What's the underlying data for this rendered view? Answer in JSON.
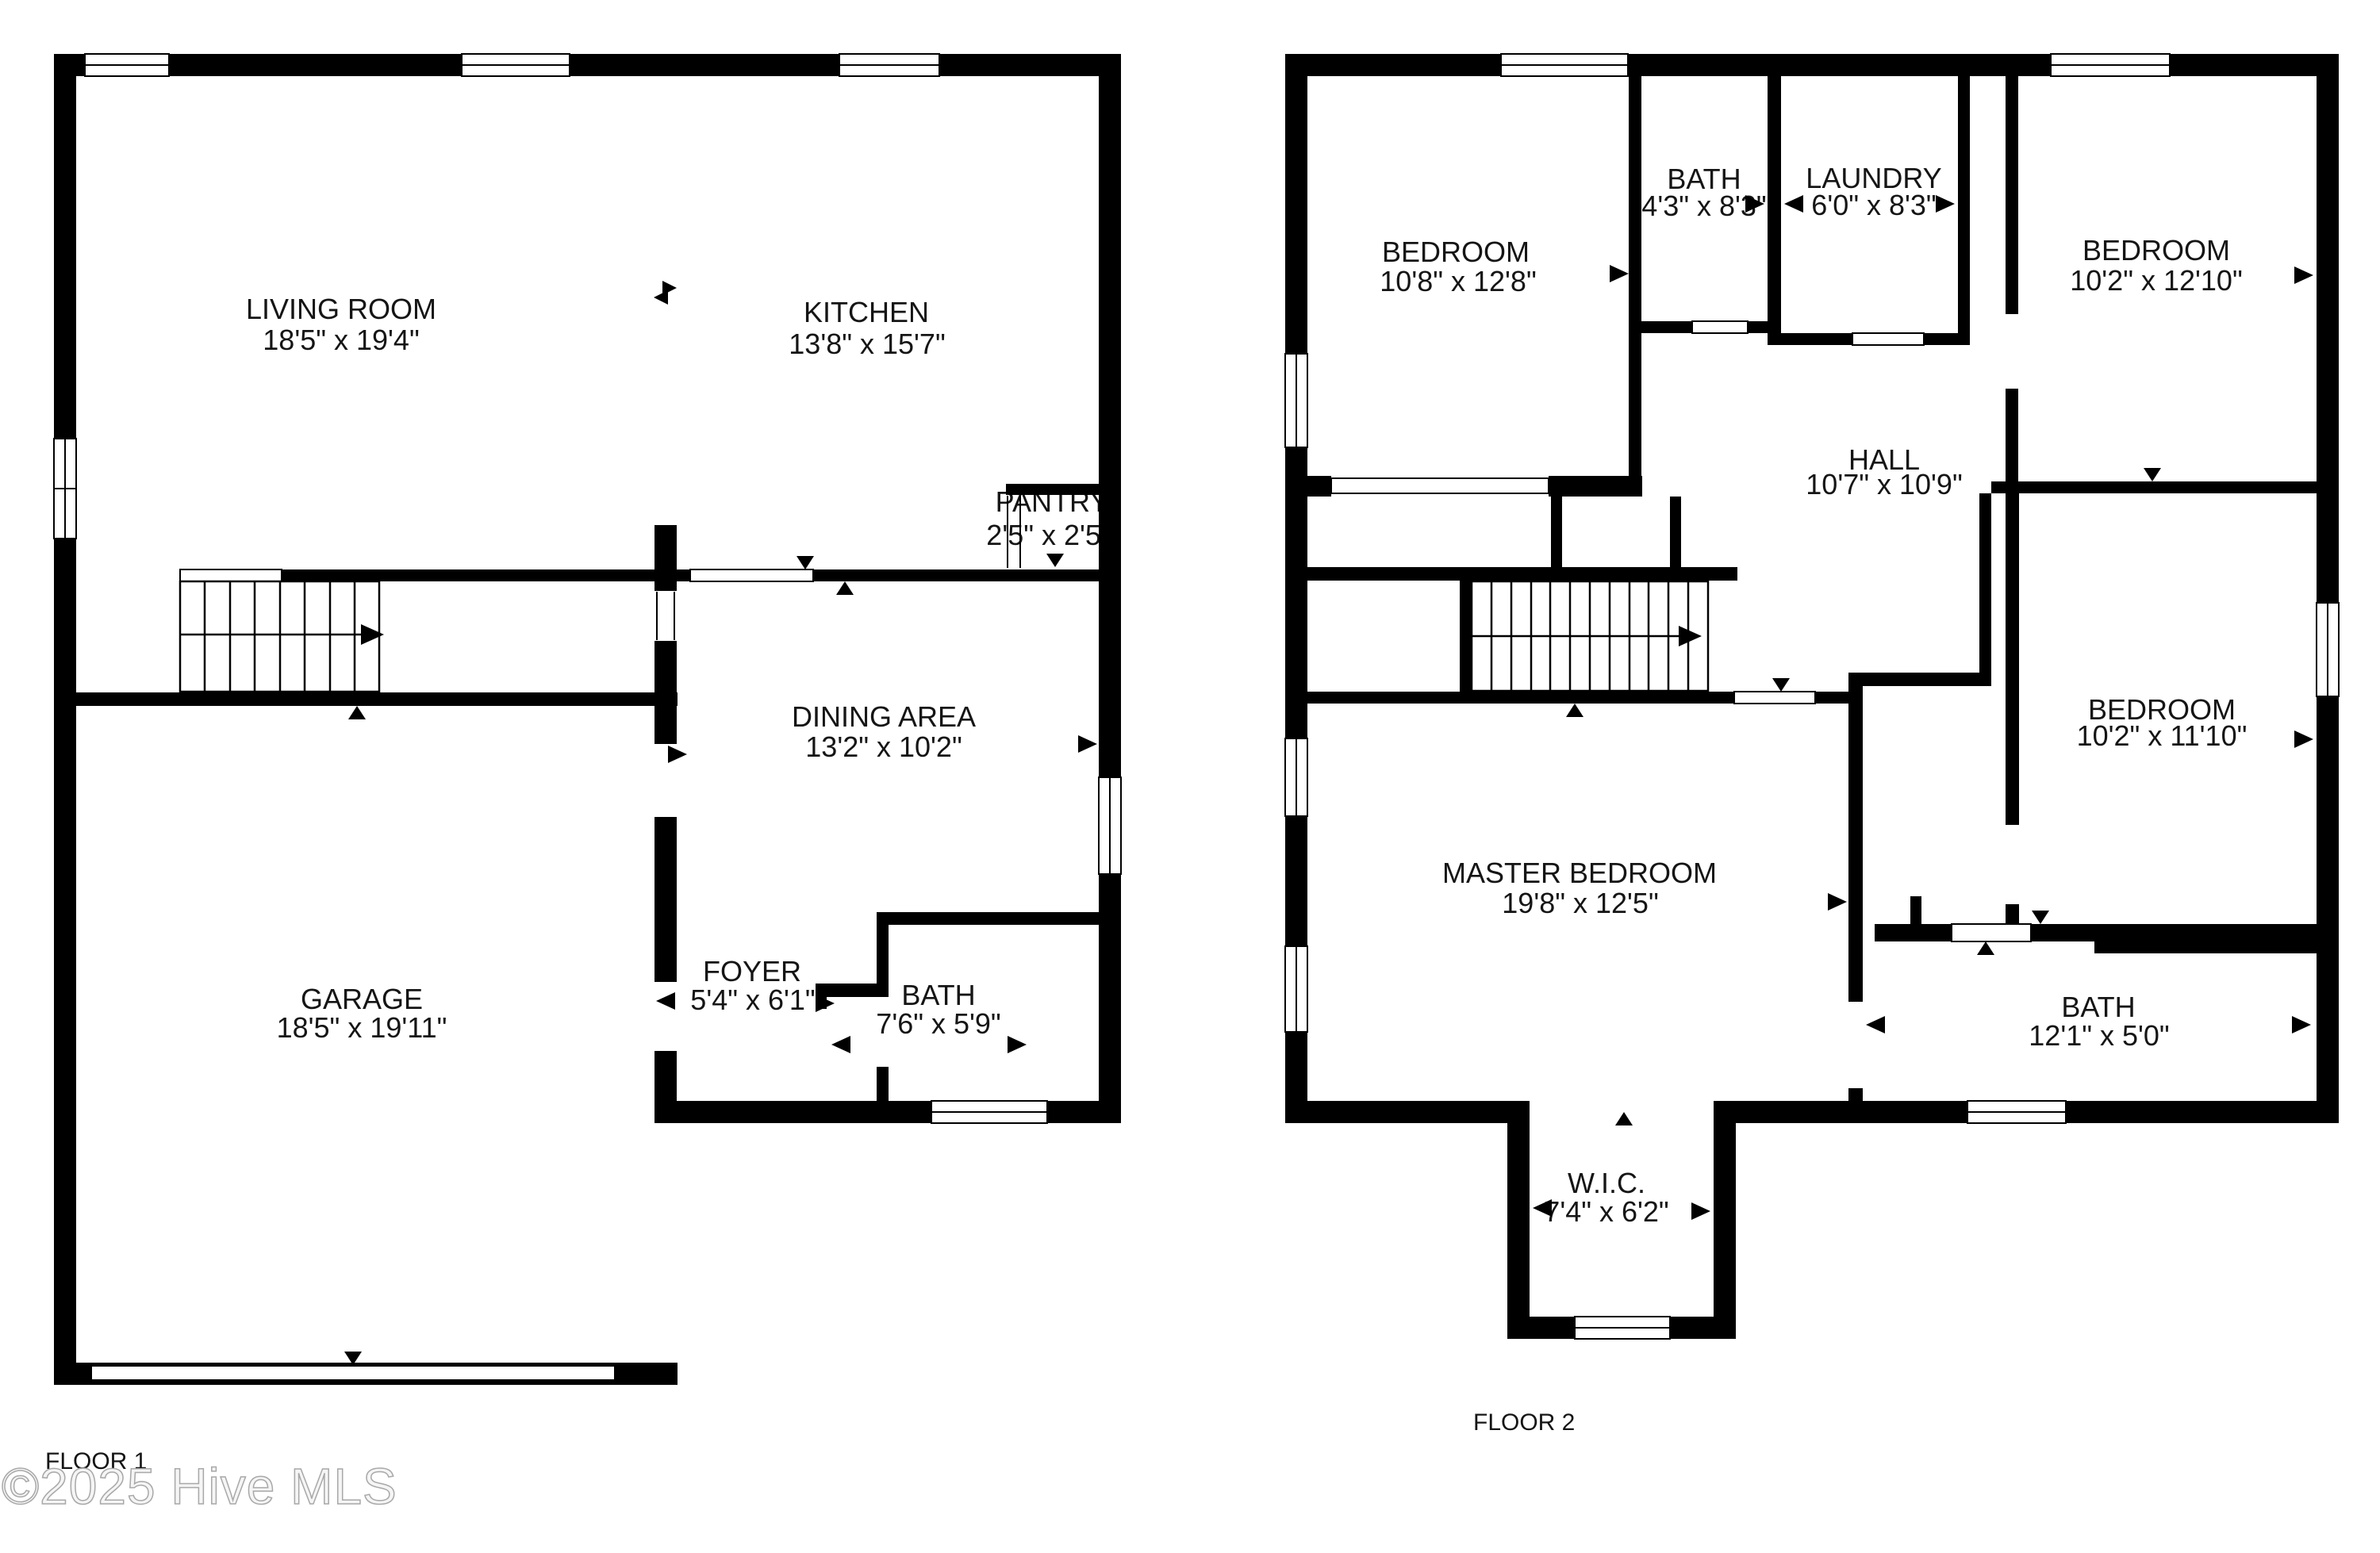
{
  "watermark": {
    "text": "©2025 Hive MLS"
  },
  "colors": {
    "wall": "#000000",
    "label": "#151515",
    "watermark_stroke": "#a8a8a8"
  },
  "floor1": {
    "title": "FLOOR 1",
    "rooms": [
      {
        "name": "LIVING ROOM",
        "dims": "18'5\" x 19'4\""
      },
      {
        "name": "KITCHEN",
        "dims": "13'8\" x 15'7\""
      },
      {
        "name": "PANTRY",
        "dims": "2'5\" x 2'5\""
      },
      {
        "name": "DINING AREA",
        "dims": "13'2\" x 10'2\""
      },
      {
        "name": "GARAGE",
        "dims": "18'5\" x 19'11\""
      },
      {
        "name": "FOYER",
        "dims": "5'4\" x 6'1\""
      },
      {
        "name": "BATH",
        "dims": "7'6\" x 5'9\""
      }
    ]
  },
  "floor2": {
    "title": "FLOOR 2",
    "rooms": [
      {
        "name": "BEDROOM",
        "dims": "10'8\" x 12'8\""
      },
      {
        "name": "BATH",
        "dims": "4'3\" x 8'3\""
      },
      {
        "name": "LAUNDRY",
        "dims": "6'0\" x 8'3\""
      },
      {
        "name": "BEDROOM",
        "dims": "10'2\" x 12'10\""
      },
      {
        "name": "HALL",
        "dims": "10'7\" x 10'9\""
      },
      {
        "name": "BEDROOM",
        "dims": "10'2\" x 11'10\""
      },
      {
        "name": "MASTER BEDROOM",
        "dims": "19'8\" x 12'5\""
      },
      {
        "name": "BATH",
        "dims": "12'1\" x 5'0\""
      },
      {
        "name": "W.I.C.",
        "dims": "7'4\" x 6'2\""
      }
    ]
  }
}
